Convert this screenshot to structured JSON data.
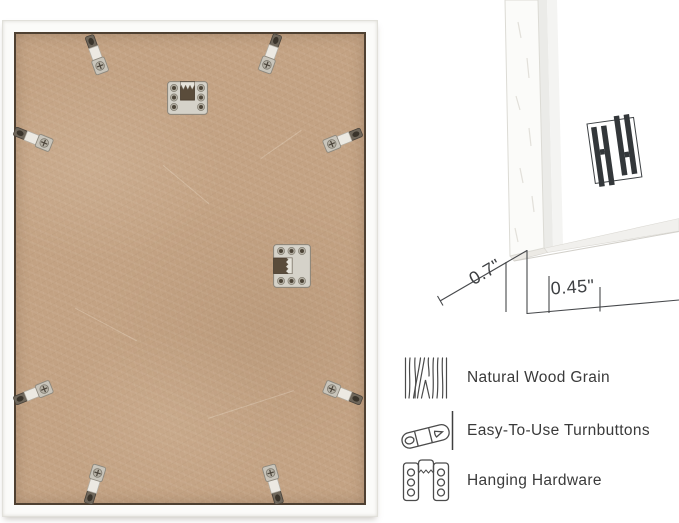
{
  "page": {
    "background": "#ffffff"
  },
  "frame_back_photo": {
    "frame_color": "#fbfbf9",
    "board_color": "#c3a283",
    "turnbutton_count": 8,
    "hanger_count": 2
  },
  "corner_detail": {
    "depth_label": "0.7\"",
    "face_width_label": "0.45\"",
    "logo_icon": "double-h-brand-logo"
  },
  "features": [
    {
      "icon": "wood-grain-icon",
      "label": "Natural Wood Grain"
    },
    {
      "icon": "turnbutton-icon",
      "label": "Easy-To-Use Turnbuttons"
    },
    {
      "icon": "hanging-hardware-icon",
      "label": "Hanging Hardware"
    }
  ]
}
